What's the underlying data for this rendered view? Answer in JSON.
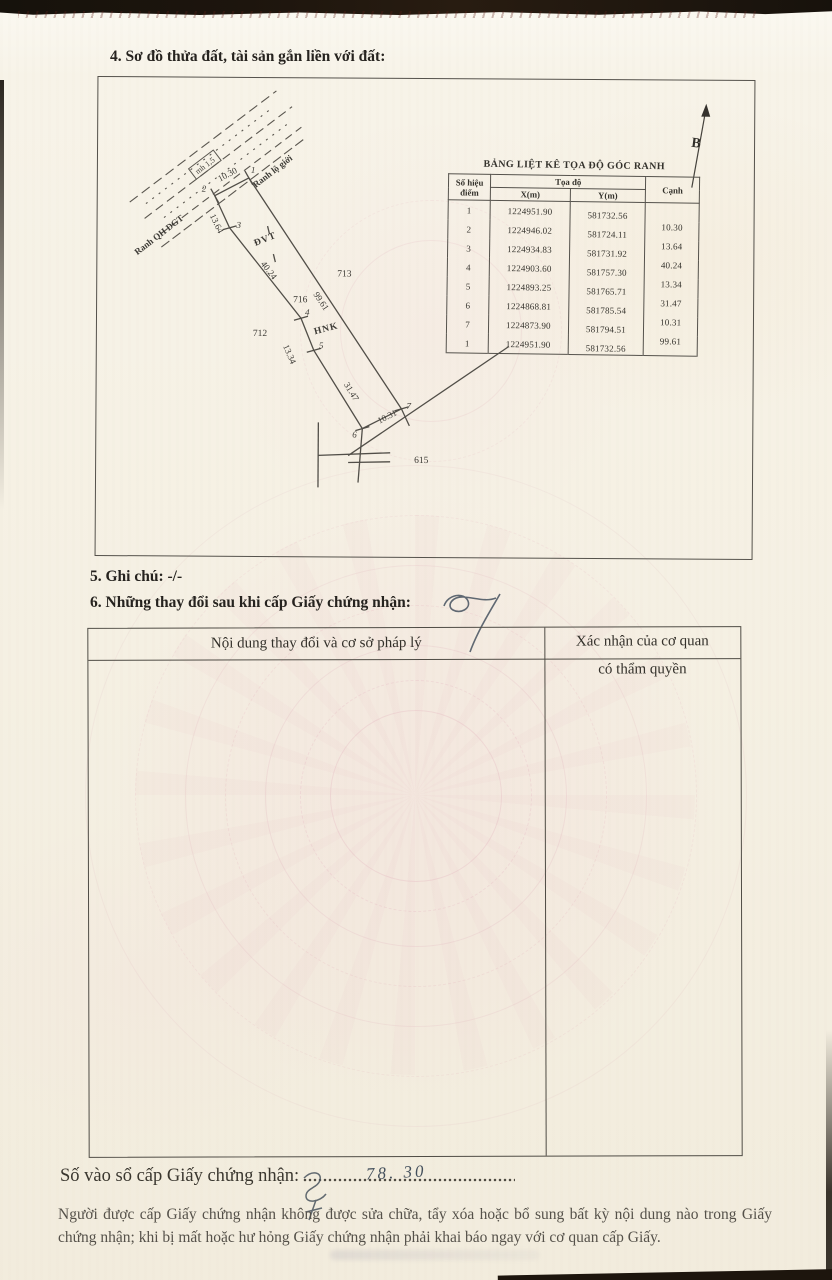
{
  "document": {
    "section4_title": "4. Sơ đồ thửa đất, tài sản gắn liền với đất:",
    "section5_text": "5. Ghi chú: -/-",
    "section6_title": "6. Những thay đổi sau khi cấp Giấy chứng nhận:",
    "serial_label": "Số vào sổ cấp Giấy chứng nhận:",
    "serial_handwritten": "78. 30",
    "footer_note": "Người được cấp Giấy chứng nhận không được sửa chữa, tẩy xóa hoặc bổ sung bất kỳ nội dung nào trong Giấy chứng nhận; khi bị mất hoặc hư hỏng Giấy chứng nhận phải khai báo ngay với cơ quan cấp Giấy."
  },
  "sketch": {
    "north_label": "B",
    "label_ranh_qh_dgt": "Ranh QH ĐGT",
    "label_ranh_lo_gioi": "Ranh lộ giới",
    "road_box_label": "mh 1,5",
    "label_dvt": "ĐVT",
    "label_hnk": "HNK",
    "parcel_number": "716",
    "adjacent_parcel_right": "713",
    "adjacent_parcel_left": "712",
    "adjacent_parcel_bottom": "615",
    "point_labels": {
      "p1": "1",
      "p2": "2",
      "p3": "3",
      "p4": "4",
      "p5": "5",
      "p6": "6",
      "p7": "7"
    },
    "edge_lengths": {
      "e12": "10.30",
      "e23": "13.64",
      "e34": "40.24",
      "e45": "13.34",
      "e56": "31.47",
      "e67": "10.31",
      "e71": "99.61"
    }
  },
  "coord_table": {
    "title": "BẢNG LIỆT KÊ TỌA ĐỘ GÓC RANH",
    "header_point_line1": "Số hiệu",
    "header_point_line2": "điểm",
    "header_coords": "Tọa độ",
    "header_x": "X(m)",
    "header_y": "Y(m)",
    "header_edge": "Cạnh",
    "rows": [
      {
        "point": "1",
        "x": "1224951.90",
        "y": "581732.56",
        "edge": ""
      },
      {
        "point": "2",
        "x": "1224946.02",
        "y": "581724.11",
        "edge": "10.30"
      },
      {
        "point": "3",
        "x": "1224934.83",
        "y": "581731.92",
        "edge": "13.64"
      },
      {
        "point": "4",
        "x": "1224903.60",
        "y": "581757.30",
        "edge": "40.24"
      },
      {
        "point": "5",
        "x": "1224893.25",
        "y": "581765.71",
        "edge": "13.34"
      },
      {
        "point": "6",
        "x": "1224868.81",
        "y": "581785.54",
        "edge": "31.47"
      },
      {
        "point": "7",
        "x": "1224873.90",
        "y": "581794.51",
        "edge": "10.31"
      },
      {
        "point": "1",
        "x": "1224951.90",
        "y": "581732.56",
        "edge": "99.61"
      }
    ]
  },
  "changes_table": {
    "col1_header": "Nội dung thay đổi và cơ sở pháp lý",
    "col2_header_line1": "Xác nhận của cơ quan",
    "col2_header_line2": "có thẩm quyền"
  },
  "colors": {
    "paper": "#f5f0e3",
    "ink": "#2e2c29",
    "line": "#55524c",
    "watermark_pink": "#e9b9c8",
    "scan_band": "#1a140e",
    "pen_ink": "#46525f"
  }
}
